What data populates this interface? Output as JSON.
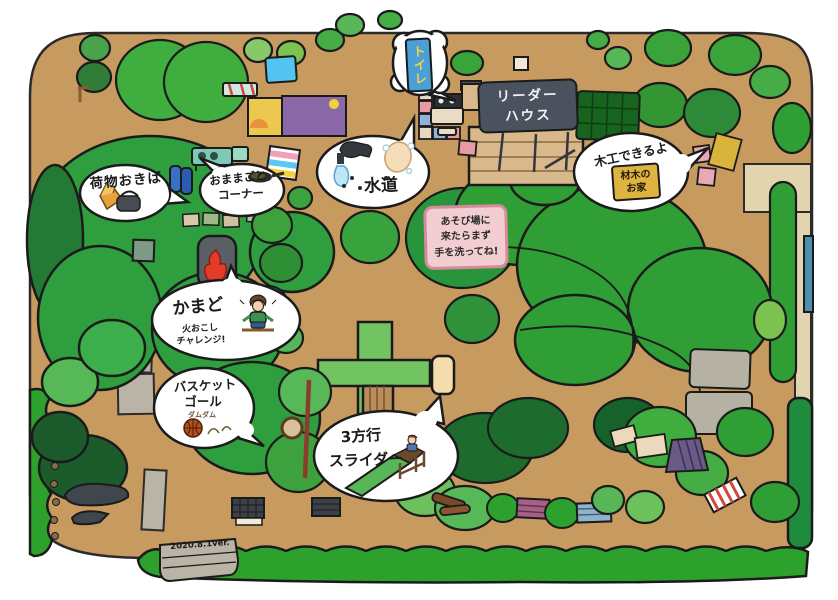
{
  "map": {
    "version_label": "2020.8.1ver."
  },
  "palette": {
    "ground": "#c79a5f",
    "hedge_green": "#2ca12c",
    "tree_main_green": "#2e9e3e",
    "tree_dark_green": "#1c5c2c",
    "leader_sign_bg": "#4a525f",
    "wash_sign_bg": "#f2cdd2",
    "wash_sign_border": "#d98a9a",
    "toilet_sign_bg": "#4b9fd8",
    "toilet_sign_text": "#f7d53d",
    "lumber_sign_bg": "#dfb33f"
  },
  "bubbles": {
    "luggage": {
      "label": "荷物おきば"
    },
    "playhouse": {
      "line1": "おままごと",
      "line2": "コーナー"
    },
    "water": {
      "label": "水道"
    },
    "toilet": {
      "label": "トイレ"
    },
    "woodwork": {
      "label": "木工できるよ",
      "sign": {
        "line1": "材木の",
        "line2": "お家"
      }
    },
    "kamado": {
      "label": "かまど",
      "sub_line1": "火おこし",
      "sub_line2": "チャレンジ!"
    },
    "basketball": {
      "line1": "バスケット",
      "line2": "ゴール",
      "sfx": "ダムダム"
    },
    "slider": {
      "line1": "3方行",
      "line2": "スライダー"
    }
  },
  "signs": {
    "leader_house": {
      "line1": "リーダー",
      "line2": "ハウス"
    },
    "wash_hands": {
      "line1": "あそび場に",
      "line2": "来たらまず",
      "line3": "手を洗ってね!"
    },
    "version_stone": {
      "label": "2020.8.1ver."
    }
  }
}
